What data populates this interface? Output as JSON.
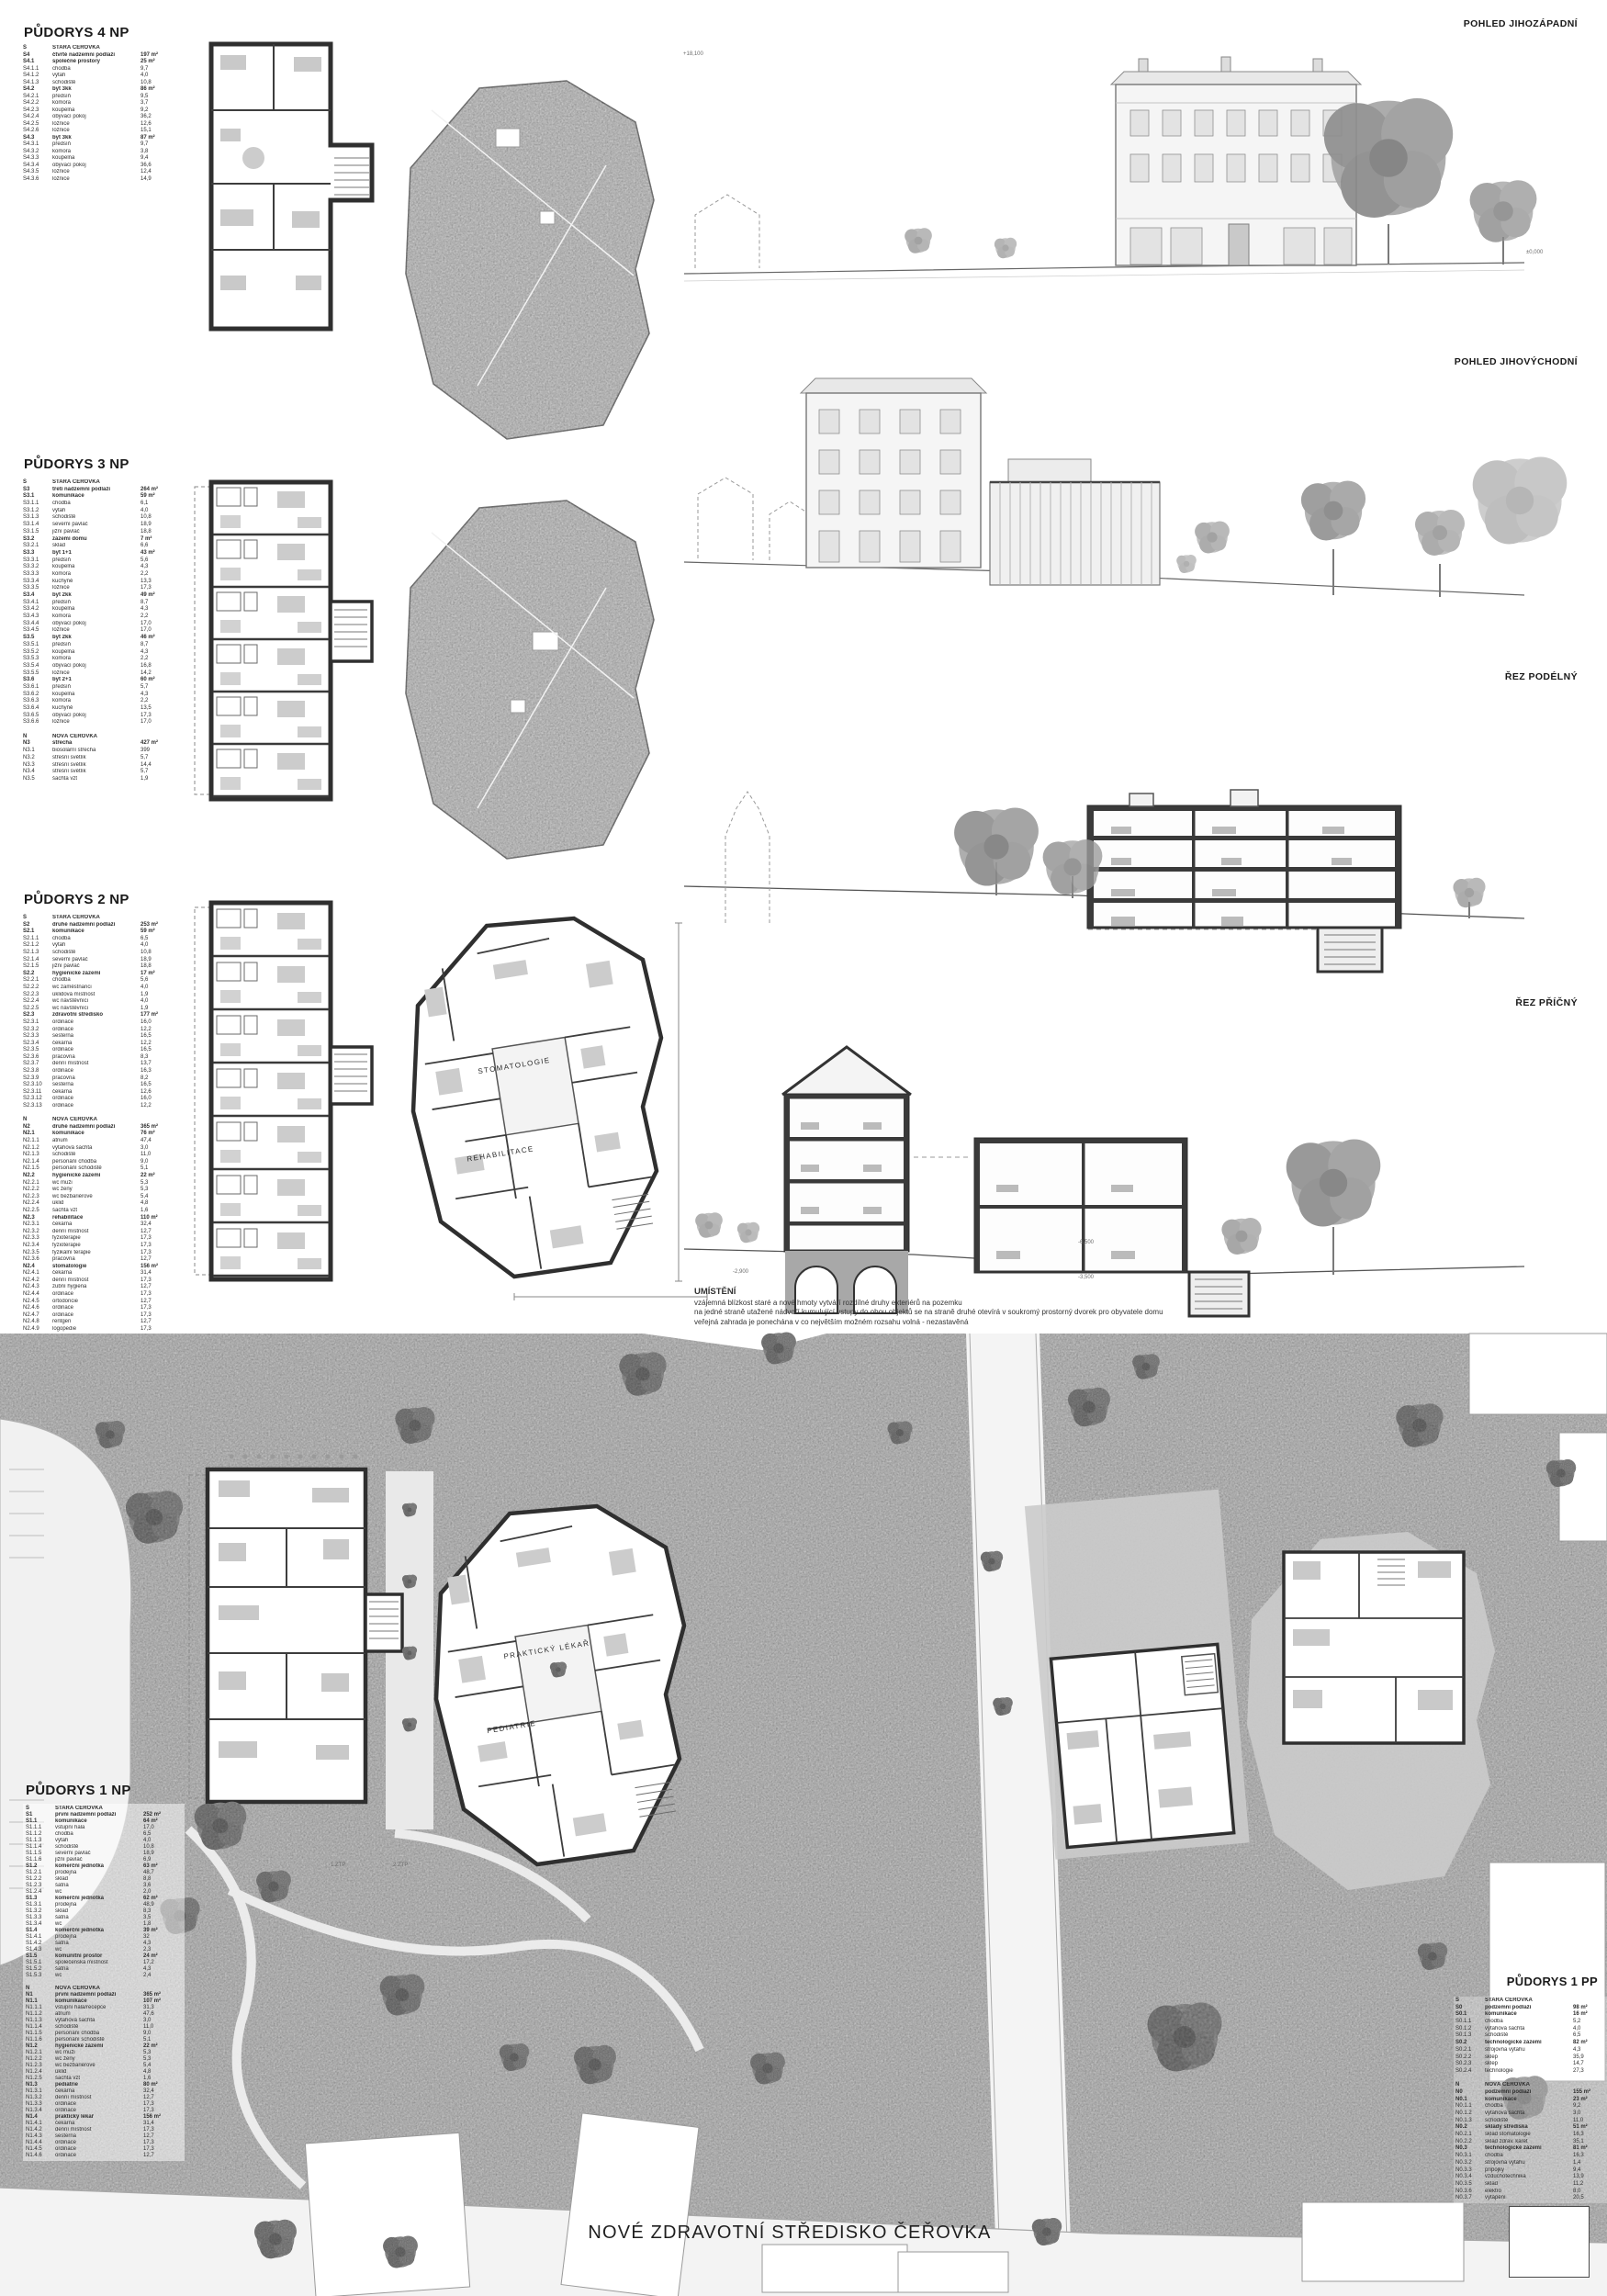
{
  "sheet": {
    "title": "NOVÉ ZDRAVOTNÍ STŘEDISKO ČEŘOVKA"
  },
  "section_labels": {
    "pohled_jz": "POHLED JIHOZÁPADNÍ",
    "pohled_jv": "POHLED JIHOVÝCHODNÍ",
    "rez_podelny": "ŘEZ PODÉLNÝ",
    "rez_pricny": "ŘEZ PŘÍČNÝ"
  },
  "umisteni": {
    "heading": "UMÍSTĚNÍ",
    "lines": [
      "vzájemná blízkost staré a nové hmoty vytváří rozdílné druhy exteriérů na pozemku",
      "na jedné straně utažené nádvoří kumulující vstupy do obou objektů se na straně druhé otevírá v soukromý prostorný dvorek pro obyvatele domu",
      "veřejná zahrada je ponechána v co největším možném rozsahu volná - nezastavěná"
    ]
  },
  "plan_labels": {
    "stomatologie": "STOMATOLOGIE",
    "rehabilitace": "REHABILITACE",
    "prakticky_lekar": "PRAKTICKÝ LÉKAŘ",
    "pediatrie": "PEDIATRIE",
    "ztp1": "1.ZTP",
    "ztp2": "2.ZTP"
  },
  "levels": [
    {
      "t": "+18,100"
    },
    {
      "t": "±0,000"
    },
    {
      "t": "-2,900"
    },
    {
      "t": "-6,500"
    },
    {
      "t": "-3,500"
    }
  ],
  "tables": {
    "np4": {
      "heading": "PŮDORYS 4 NP",
      "rows": [
        [
          "S",
          "STARÁ ČEŘOVKA",
          "",
          1
        ],
        [
          "S4",
          "čtvrté nadzemní podlaží",
          "197 m²",
          1
        ],
        [
          "S4.1",
          "společné prostory",
          "25 m²",
          1
        ],
        [
          "S4.1.1",
          "chodba",
          "9,7"
        ],
        [
          "S4.1.2",
          "výtah",
          "4,0"
        ],
        [
          "S4.1.3",
          "schodiště",
          "10,8"
        ],
        [
          "S4.2",
          "byt 3kk",
          "86 m²",
          1
        ],
        [
          "S4.2.1",
          "předsíň",
          "9,5"
        ],
        [
          "S4.2.2",
          "komora",
          "3,7"
        ],
        [
          "S4.2.3",
          "koupelna",
          "9,2"
        ],
        [
          "S4.2.4",
          "obývací pokoj",
          "36,2"
        ],
        [
          "S4.2.5",
          "ložnice",
          "12,6"
        ],
        [
          "S4.2.6",
          "ložnice",
          "15,1"
        ],
        [
          "S4.3",
          "byt 3kk",
          "87 m²",
          1
        ],
        [
          "S4.3.1",
          "předsíň",
          "9,7"
        ],
        [
          "S4.3.2",
          "komora",
          "3,8"
        ],
        [
          "S4.3.3",
          "koupelna",
          "9,4"
        ],
        [
          "S4.3.4",
          "obývací pokoj",
          "36,6"
        ],
        [
          "S4.3.5",
          "ložnice",
          "12,4"
        ],
        [
          "S4.3.6",
          "ložnice",
          "14,9"
        ]
      ]
    },
    "np3": {
      "heading": "PŮDORYS 3 NP",
      "rows": [
        [
          "S",
          "STARÁ ČEŘOVKA",
          "",
          1
        ],
        [
          "S3",
          "třetí nadzemní podlaží",
          "264 m²",
          1
        ],
        [
          "S3.1",
          "komunikace",
          "59 m²",
          1
        ],
        [
          "S3.1.1",
          "chodba",
          "6,1"
        ],
        [
          "S3.1.2",
          "výtah",
          "4,0"
        ],
        [
          "S3.1.3",
          "schodiště",
          "10,8"
        ],
        [
          "S3.1.4",
          "severní pavlač",
          "18,9"
        ],
        [
          "S3.1.5",
          "jižní pavlač",
          "18,8"
        ],
        [
          "S3.2",
          "zázemí domu",
          "7 m²",
          1
        ],
        [
          "S3.2.1",
          "sklad",
          "6,6"
        ],
        [
          "S3.3",
          "byt 1+1",
          "43 m²",
          1
        ],
        [
          "S3.3.1",
          "předsíň",
          "5,6"
        ],
        [
          "S3.3.2",
          "koupelna",
          "4,3"
        ],
        [
          "S3.3.3",
          "komora",
          "2,2"
        ],
        [
          "S3.3.4",
          "kuchyně",
          "13,3"
        ],
        [
          "S3.3.5",
          "ložnice",
          "17,3"
        ],
        [
          "S3.4",
          "byt 2kk",
          "49 m²",
          1
        ],
        [
          "S3.4.1",
          "předsíň",
          "8,7"
        ],
        [
          "S3.4.2",
          "koupelna",
          "4,3"
        ],
        [
          "S3.4.3",
          "komora",
          "2,2"
        ],
        [
          "S3.4.4",
          "obývací pokoj",
          "17,0"
        ],
        [
          "S3.4.5",
          "ložnice",
          "17,0"
        ],
        [
          "S3.5",
          "byt 2kk",
          "46 m²",
          1
        ],
        [
          "S3.5.1",
          "předsíň",
          "8,7"
        ],
        [
          "S3.5.2",
          "koupelna",
          "4,3"
        ],
        [
          "S3.5.3",
          "komora",
          "2,2"
        ],
        [
          "S3.5.4",
          "obývací pokoj",
          "16,8"
        ],
        [
          "S3.5.5",
          "ložnice",
          "14,2"
        ],
        [
          "S3.6",
          "byt 2+1",
          "60 m²",
          1
        ],
        [
          "S3.6.1",
          "předsíň",
          "5,7"
        ],
        [
          "S3.6.2",
          "koupelna",
          "4,3"
        ],
        [
          "S3.6.3",
          "komora",
          "2,2"
        ],
        [
          "S3.6.4",
          "kuchyně",
          "13,5"
        ],
        [
          "S3.6.5",
          "obývací pokoj",
          "17,3"
        ],
        [
          "S3.6.6",
          "ložnice",
          "17,0"
        ],
        [],
        [
          "N",
          "NOVÁ ČEŘOVKA",
          "",
          1
        ],
        [
          "N3",
          "střecha",
          "427 m²",
          1
        ],
        [
          "N3.1",
          "biosolární střecha",
          "399"
        ],
        [
          "N3.2",
          "střešní světlík",
          "5,7"
        ],
        [
          "N3.3",
          "střešní světlík",
          "14,4"
        ],
        [
          "N3.4",
          "střešní světlík",
          "5,7"
        ],
        [
          "N3.5",
          "šachta vzt",
          "1,9"
        ]
      ]
    },
    "np2": {
      "heading": "PŮDORYS 2 NP",
      "rows": [
        [
          "S",
          "STARÁ ČEŘOVKA",
          "",
          1
        ],
        [
          "S2",
          "druhé nadzemní podlaží",
          "253 m²",
          1
        ],
        [
          "S2.1",
          "komunikace",
          "59 m²",
          1
        ],
        [
          "S2.1.1",
          "chodba",
          "6,5"
        ],
        [
          "S2.1.2",
          "výtah",
          "4,0"
        ],
        [
          "S2.1.3",
          "schodiště",
          "10,8"
        ],
        [
          "S2.1.4",
          "severní pavlač",
          "18,9"
        ],
        [
          "S2.1.5",
          "jižní pavlač",
          "18,8"
        ],
        [
          "S2.2",
          "hygienické zázemí",
          "17 m²",
          1
        ],
        [
          "S2.2.1",
          "chodba",
          "5,6"
        ],
        [
          "S2.2.2",
          "wc zaměstnanci",
          "4,0"
        ],
        [
          "S2.2.3",
          "úklidová místnost",
          "1,9"
        ],
        [
          "S2.2.4",
          "wc návštěvníci",
          "4,0"
        ],
        [
          "S2.2.5",
          "wc návštěvníci",
          "1,9"
        ],
        [
          "S2.3",
          "zdravotní středisko",
          "177 m²",
          1
        ],
        [
          "S2.3.1",
          "ordinace",
          "16,0"
        ],
        [
          "S2.3.2",
          "ordinace",
          "12,2"
        ],
        [
          "S2.3.3",
          "sesterna",
          "16,5"
        ],
        [
          "S2.3.4",
          "čekárna",
          "12,2"
        ],
        [
          "S2.3.5",
          "ordinace",
          "16,5"
        ],
        [
          "S2.3.6",
          "pracovna",
          "8,3"
        ],
        [
          "S2.3.7",
          "denní místnost",
          "13,7"
        ],
        [
          "S2.3.8",
          "ordinace",
          "16,3"
        ],
        [
          "S2.3.9",
          "pracovna",
          "8,2"
        ],
        [
          "S2.3.10",
          "sesterna",
          "16,5"
        ],
        [
          "S2.3.11",
          "čekárna",
          "12,6"
        ],
        [
          "S2.3.12",
          "ordinace",
          "16,0"
        ],
        [
          "S2.3.13",
          "ordinace",
          "12,2"
        ],
        [],
        [
          "N",
          "NOVÁ ČEŘOVKA",
          "",
          1
        ],
        [
          "N2",
          "druhé nadzemní podlaží",
          "365 m²",
          1
        ],
        [
          "N2.1",
          "komunikace",
          "76 m²",
          1
        ],
        [
          "N2.1.1",
          "atrium",
          "47,4"
        ],
        [
          "N2.1.2",
          "výtahová šachta",
          "3,0"
        ],
        [
          "N2.1.3",
          "schodiště",
          "11,0"
        ],
        [
          "N2.1.4",
          "personání chodba",
          "9,0"
        ],
        [
          "N2.1.5",
          "personání schodiště",
          "5,1"
        ],
        [
          "N2.2",
          "hygienické zázemí",
          "22 m²",
          1
        ],
        [
          "N2.2.1",
          "wc muži",
          "5,3"
        ],
        [
          "N2.2.2",
          "wc ženy",
          "5,3"
        ],
        [
          "N2.2.3",
          "wc bezbariérové",
          "5,4"
        ],
        [
          "N2.2.4",
          "úklid",
          "4,8"
        ],
        [
          "N2.2.5",
          "šachta vzt",
          "1,6"
        ],
        [
          "N2.3",
          "rehabilitace",
          "110 m²",
          1
        ],
        [
          "N2.3.1",
          "čekárna",
          "32,4"
        ],
        [
          "N2.3.2",
          "denní místnost",
          "12,7"
        ],
        [
          "N2.3.3",
          "fyzioterapie",
          "17,3"
        ],
        [
          "N2.3.4",
          "fyzioterapie",
          "17,3"
        ],
        [
          "N2.3.5",
          "fyzikální terapie",
          "17,3"
        ],
        [
          "N2.3.6",
          "pracovna",
          "12,7"
        ],
        [
          "N2.4",
          "stomatologie",
          "156 m²",
          1
        ],
        [
          "N2.4.1",
          "čekárna",
          "31,4"
        ],
        [
          "N2.4.2",
          "denní místnost",
          "17,3"
        ],
        [
          "N2.4.3",
          "zubní hygiena",
          "12,7"
        ],
        [
          "N2.4.4",
          "ordinace",
          "17,3"
        ],
        [
          "N2.4.5",
          "ortodoncie",
          "12,7"
        ],
        [
          "N2.4.6",
          "ordinace",
          "17,3"
        ],
        [
          "N2.4.7",
          "ordinace",
          "17,3"
        ],
        [
          "N2.4.8",
          "rentgen",
          "12,7"
        ],
        [
          "N2.4.9",
          "logopedie",
          "17,3"
        ]
      ]
    },
    "np1": {
      "heading": "PŮDORYS 1 NP",
      "rows": [
        [
          "S",
          "STARÁ ČEŘOVKA",
          "",
          1
        ],
        [
          "S1",
          "první nadzemní podlaží",
          "252 m²",
          1
        ],
        [
          "S1.1",
          "komunikace",
          "64 m²",
          1
        ],
        [
          "S1.1.1",
          "vstupní hala",
          "17,0"
        ],
        [
          "S1.1.2",
          "chodba",
          "6,5"
        ],
        [
          "S1.1.3",
          "výtah",
          "4,0"
        ],
        [
          "S1.1.4",
          "schodiště",
          "10,8"
        ],
        [
          "S1.1.5",
          "severní pavlač",
          "18,9"
        ],
        [
          "S1.1.6",
          "jižní pavlač",
          "6,9"
        ],
        [
          "S1.2",
          "komerční jednotka",
          "63 m²",
          1
        ],
        [
          "S1.2.1",
          "prodejna",
          "48,7"
        ],
        [
          "S1.2.2",
          "sklad",
          "8,8"
        ],
        [
          "S1.2.3",
          "šatna",
          "3,6"
        ],
        [
          "S1.2.4",
          "wc",
          "2,0"
        ],
        [
          "S1.3",
          "komerční jednotka",
          "62 m²",
          1
        ],
        [
          "S1.3.1",
          "prodejna",
          "48,9"
        ],
        [
          "S1.3.2",
          "sklad",
          "8,3"
        ],
        [
          "S1.3.3",
          "šatna",
          "3,5"
        ],
        [
          "S1.3.4",
          "wc",
          "1,8"
        ],
        [
          "S1.4",
          "komerční jednotka",
          "39 m²",
          1
        ],
        [
          "S1.4.1",
          "prodejna",
          "32"
        ],
        [
          "S1.4.2",
          "šatna",
          "4,3"
        ],
        [
          "S1.4.3",
          "wc",
          "2,3"
        ],
        [
          "S1.5",
          "komunitní prostor",
          "24 m²",
          1
        ],
        [
          "S1.5.1",
          "společenská místnost",
          "17,2"
        ],
        [
          "S1.5.2",
          "šatna",
          "4,3"
        ],
        [
          "S1.5.3",
          "wc",
          "2,4"
        ],
        [],
        [
          "N",
          "NOVÁ ČEŘOVKA",
          "",
          1
        ],
        [
          "N1",
          "první nadzemní podlaží",
          "365 m²",
          1
        ],
        [
          "N1.1",
          "komunikace",
          "107 m²",
          1
        ],
        [
          "N1.1.1",
          "vstupní hala/recepce",
          "31,3"
        ],
        [
          "N1.1.2",
          "atrium",
          "47,6"
        ],
        [
          "N1.1.3",
          "výtahová šachta",
          "3,0"
        ],
        [
          "N1.1.4",
          "schodiště",
          "11,0"
        ],
        [
          "N1.1.5",
          "personání chodba",
          "9,0"
        ],
        [
          "N1.1.6",
          "personání schodiště",
          "5,1"
        ],
        [
          "N1.2",
          "hygienické zázemí",
          "22 m²",
          1
        ],
        [
          "N1.2.1",
          "wc muži",
          "5,3"
        ],
        [
          "N1.2.2",
          "wc ženy",
          "5,3"
        ],
        [
          "N1.2.3",
          "wc bezbariérové",
          "5,4"
        ],
        [
          "N1.2.4",
          "úklid",
          "4,8"
        ],
        [
          "N1.2.5",
          "šachta vzt",
          "1,6"
        ],
        [
          "N1.3",
          "pediatrie",
          "80 m²",
          1
        ],
        [
          "N1.3.1",
          "čekárna",
          "32,4"
        ],
        [
          "N1.3.2",
          "denní místnost",
          "12,7"
        ],
        [
          "N1.3.3",
          "ordinace",
          "17,3"
        ],
        [
          "N1.3.4",
          "ordinace",
          "17,3"
        ],
        [
          "N1.4",
          "praktický lékař",
          "156 m²",
          1
        ],
        [
          "N1.4.1",
          "čekárna",
          "31,4"
        ],
        [
          "N1.4.2",
          "denní místnost",
          "17,3"
        ],
        [
          "N1.4.3",
          "sesterna",
          "12,7"
        ],
        [
          "N1.4.4",
          "ordinace",
          "17,3"
        ],
        [
          "N1.4.5",
          "ordinace",
          "17,3"
        ],
        [
          "N1.4.6",
          "ordinace",
          "12,7"
        ]
      ]
    },
    "pp1": {
      "heading": "PŮDORYS 1 PP",
      "rows": [
        [
          "S",
          "STARÁ ČEŘOVKA",
          "",
          1
        ],
        [
          "S0",
          "podzemní podlaží",
          "98 m²",
          1
        ],
        [
          "S0.1",
          "komunikace",
          "16 m²",
          1
        ],
        [
          "S0.1.1",
          "chodba",
          "5,2"
        ],
        [
          "S0.1.2",
          "výtahová šachta",
          "4,0"
        ],
        [
          "S0.1.3",
          "schodiště",
          "6,5"
        ],
        [
          "S0.2",
          "technologické zázemí",
          "82 m²",
          1
        ],
        [
          "S0.2.1",
          "strojovna výtahu",
          "4,3"
        ],
        [
          "S0.2.2",
          "sklep",
          "35,9"
        ],
        [
          "S0.2.3",
          "sklep",
          "14,7"
        ],
        [
          "S0.2.4",
          "technologie",
          "27,3"
        ],
        [],
        [
          "N",
          "NOVÁ ČEŘOVKA",
          "",
          1
        ],
        [
          "N0",
          "podzemní podlaží",
          "155 m²",
          1
        ],
        [
          "N0.1",
          "komunikace",
          "23 m²",
          1
        ],
        [
          "N0.1.1",
          "chodba",
          "9,2"
        ],
        [
          "N0.1.2",
          "výtahová šachta",
          "3,0"
        ],
        [
          "N0.1.3",
          "schodiště",
          "11,0"
        ],
        [
          "N0.2",
          "sklady střediska",
          "51 m²",
          1
        ],
        [
          "N0.2.1",
          "sklad stomatologie",
          "16,3"
        ],
        [
          "N0.2.2",
          "sklad zdrav. karet",
          "35,1"
        ],
        [
          "N0.3",
          "technologické zázemí",
          "81 m²",
          1
        ],
        [
          "N0.3.1",
          "chodba",
          "16,3"
        ],
        [
          "N0.3.2",
          "strojovna výtahu",
          "1,4"
        ],
        [
          "N0.3.3",
          "přípojky",
          "9,4"
        ],
        [
          "N0.3.4",
          "vzduchotechnika",
          "13,9"
        ],
        [
          "N0.3.5",
          "sklad",
          "11,2"
        ],
        [
          "N0.3.6",
          "elektro",
          "8,0"
        ],
        [
          "N0.3.7",
          "vytápění",
          "20,5"
        ]
      ]
    }
  }
}
